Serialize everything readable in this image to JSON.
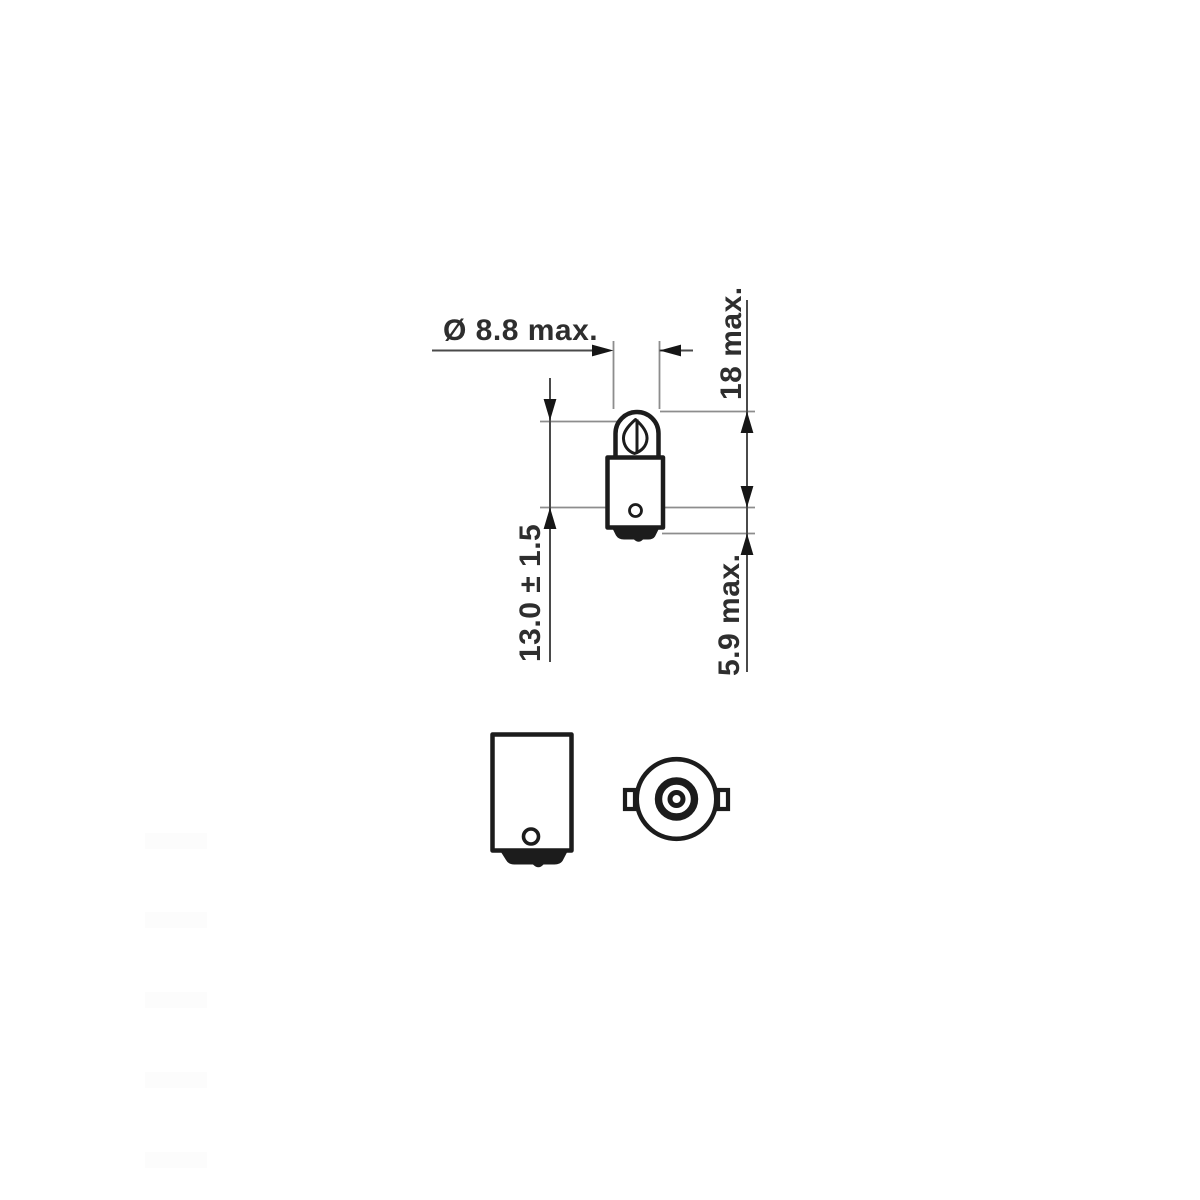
{
  "diagram": {
    "type": "bulb-dimension-drawing",
    "dimensions": {
      "diameter": "Ø 8.8 max.",
      "overall_length": "18 max.",
      "light_center_length": "13.0 ± 1.5",
      "base_length": "5.9 max."
    },
    "colors": {
      "background": "#ffffff",
      "outline": "#1c1c1c",
      "dimension_line": "#4a4a4a",
      "reference_line": "#8d8d8d",
      "text": "#2e2e2e"
    }
  }
}
